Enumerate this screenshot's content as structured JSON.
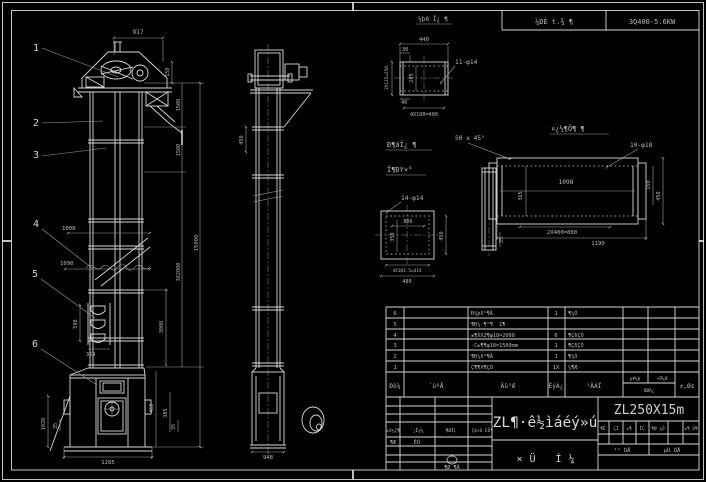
{
  "sheet": {
    "header": {
      "left": "¼ÐÈ t.¾ ¶",
      "right": "3Q400-5.6KW"
    },
    "colors": {
      "background": "#000000",
      "line": "#d9d9d9",
      "dim_text": "#b9b9b9"
    }
  },
  "front_view": {
    "callouts": [
      "1",
      "2",
      "3",
      "4",
      "5",
      "6"
    ],
    "dims": {
      "top_width": "917",
      "head_height": "150",
      "upper_section": "1500",
      "mid_section": "1500",
      "runs": "3X2000",
      "total_height": "15000",
      "lower_section": "3000",
      "boot_height": "460",
      "feed_a": "1008",
      "feed_b": "1090",
      "bucket_pitch": "590",
      "bucket_width": "369",
      "boot_left": "1020",
      "boot_left_small": "35",
      "boot_right": "385",
      "boot_right_small": "35",
      "boot_width": "1285"
    }
  },
  "side_view": {
    "dims": {
      "upper": "450",
      "base": "948"
    }
  },
  "detail_top": {
    "label": "¼þ6 Î¿ ¶",
    "dims": {
      "width": "440",
      "offset": "30",
      "holes": "11-φ14",
      "height": "295",
      "side": "2X125=250",
      "foot": "40",
      "pitch": "4X100=400"
    }
  },
  "detail_mid": {
    "label_line1": "Ð¶áÎ¿ ¶",
    "label_line2": "Î¶ÐÝ×°",
    "dims": {
      "holes": "14-φ14",
      "top": "806",
      "left": "350",
      "right": "450",
      "pitch": "4X103.5=414",
      "width": "480",
      "end_view": "35"
    }
  },
  "detail_right": {
    "label": "¤¿½¶Ô¶ ¶",
    "dims": {
      "chamfer": "50 x 45°",
      "holes": "10-φ18",
      "inner": "1098",
      "side": "365",
      "pitch": "2X400=800",
      "width": "1190",
      "right_a": "150",
      "right_b": "450"
    }
  },
  "bom": {
    "headers": {
      "seq": "Ðò¼",
      "code": "´úºÅ",
      "name": "Ãû³Æ",
      "qty": "ÊýÁ¿",
      "material": "²ÄÁÏ",
      "weight_unit": "µ¥¼þ",
      "weight_total": "×Ü¼Æ",
      "weight_label": "ÖØÁ¿",
      "remark": "±,Ø¢"
    },
    "rows": [
      {
        "seq": "6",
        "code": "",
        "name": "Ð¼þX°¶Ä",
        "qty": "1",
        "material": "¶¼Ó",
        "remark": ""
      },
      {
        "seq": "5",
        "code": "",
        "name": "¶Ð¼·¶°¶´ 1¶",
        "qty": "",
        "material": "",
        "remark": ""
      },
      {
        "seq": "4",
        "code": "",
        "name": "±¶XX2¶φ18=2000",
        "qty": "6",
        "material": "¶Ç6ÇÓ",
        "remark": ""
      },
      {
        "seq": "3",
        "code": "",
        "name": "·C±¶¶φ18=1500mm",
        "qty": "1",
        "material": "¶Ç6ÇÓ",
        "remark": ""
      },
      {
        "seq": "2",
        "code": "",
        "name": "¶Ð¼X°¶Ä",
        "qty": "1",
        "material": "¶¼Ó",
        "remark": ""
      },
      {
        "seq": "1",
        "code": "",
        "name": "Ç¶¶X¶ÇÓ",
        "qty": "1X",
        "material": "¼¶Æ·",
        "remark": ""
      }
    ]
  },
  "title_block": {
    "model": "ZL250X15m",
    "title": "ZL¶·ê½ìáéý»ú",
    "subtitle": "×Ü Í¼",
    "rev_headers": [
      "±ê¼Ç¶",
      "´¦Êý¼",
      "¶ØÎļ",
      "Ç©×Ó",
      "ÈÕ¶"
    ],
    "rev_row": [
      "¶Æ",
      "ÊÓ"
    ],
    "rev_bottom": "¶Ø ¶Ä",
    "info_cells": [
      "¶Ê",
      "ÇÏ",
      "±¶",
      "ÏÇ",
      "¶Ø ¼Ó",
      "±¶ Ó¶"
    ],
    "sheets": [
      "¹² ÕÅ",
      "µÚ ÕÅ"
    ]
  }
}
